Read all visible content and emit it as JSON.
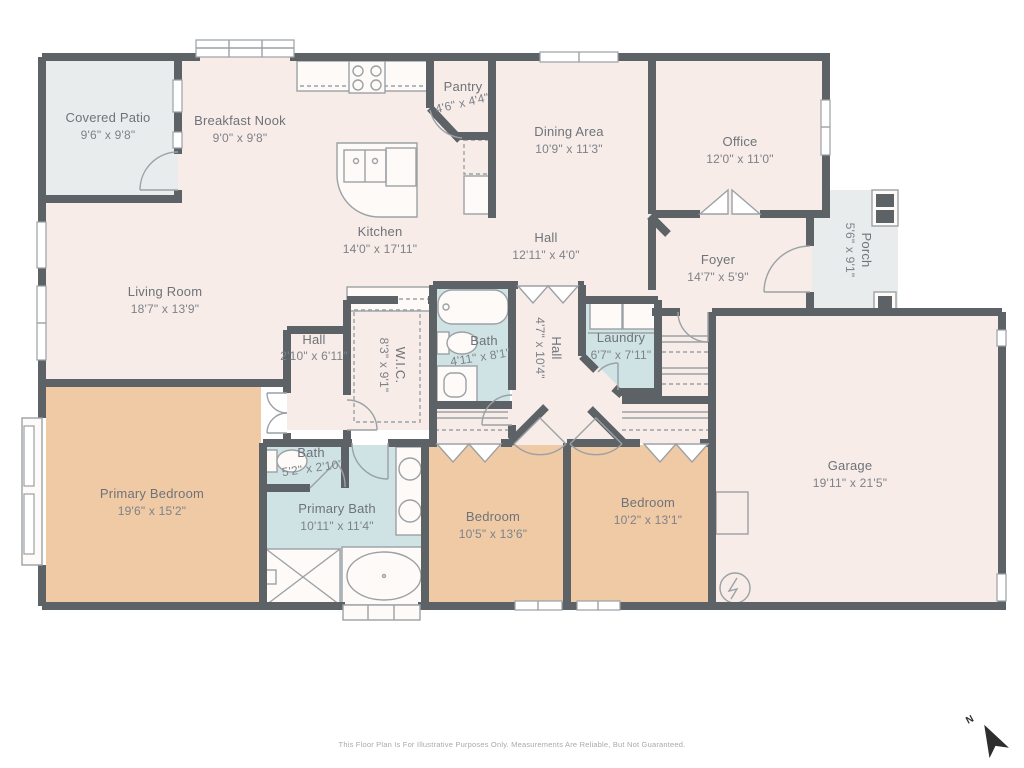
{
  "meta": {
    "disclaimer": "This Floor Plan Is For Illustrative Purposes Only. Measurements Are Reliable, But Not Guaranteed.",
    "north_label": "N"
  },
  "colors": {
    "wall": "#5d6267",
    "floor": "#f7ece8",
    "bedroom": "#f0caa5",
    "bath": "#cfe3e4",
    "outdoor": "#e9ecec",
    "fixline": "#9ba1a5",
    "label": "#6e737a",
    "dims": "#7d828a",
    "footer": "#a9a9a9",
    "north": "#2e2e2e"
  },
  "rooms": [
    {
      "name": "Covered Patio",
      "dims": "9'6\" x 9'8\""
    },
    {
      "name": "Breakfast Nook",
      "dims": "9'0\" x 9'8\""
    },
    {
      "name": "Pantry",
      "dims": "4'6\" x 4'4\""
    },
    {
      "name": "Dining Area",
      "dims": "10'9\" x 11'3\""
    },
    {
      "name": "Office",
      "dims": "12'0\" x 11'0\""
    },
    {
      "name": "Kitchen",
      "dims": "14'0\" x 17'11\""
    },
    {
      "name": "Hall",
      "dims": "12'11\" x 4'0\""
    },
    {
      "name": "Foyer",
      "dims": "14'7\" x 5'9\""
    },
    {
      "name": "Porch",
      "dims": "5'6\" x 9'1\""
    },
    {
      "name": "Living Room",
      "dims": "18'7\" x 13'9\""
    },
    {
      "name": "Hall",
      "dims": "2'10\" x 6'11\""
    },
    {
      "name": "W.I.C.",
      "dims": "8'3\" x 9'1\""
    },
    {
      "name": "Bath",
      "dims": "4'11\" x 8'1\""
    },
    {
      "name": "Hall",
      "dims": "4'7\" x 10'4\""
    },
    {
      "name": "Laundry",
      "dims": "6'7\" x 7'11\""
    },
    {
      "name": "Garage",
      "dims": "19'11\" x 21'5\""
    },
    {
      "name": "Primary Bedroom",
      "dims": "19'6\" x 15'2\""
    },
    {
      "name": "Bath",
      "dims": "5'2\" x 2'10\""
    },
    {
      "name": "Primary Bath",
      "dims": "10'11\" x 11'4\""
    },
    {
      "name": "Bedroom",
      "dims": "10'5\" x 13'6\""
    },
    {
      "name": "Bedroom",
      "dims": "10'2\" x 13'1\""
    }
  ]
}
